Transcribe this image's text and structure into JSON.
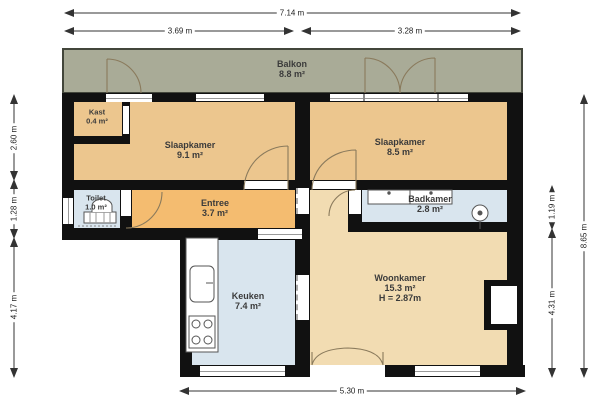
{
  "plan": {
    "rooms": {
      "balkon": {
        "name": "Balkon",
        "area": "8.8 m²"
      },
      "kast": {
        "name": "Kast",
        "area": "0.4 m²"
      },
      "slaapkamer1": {
        "name": "Slaapkamer",
        "area": "9.1 m²"
      },
      "slaapkamer2": {
        "name": "Slaapkamer",
        "area": "8.5 m²"
      },
      "toilet": {
        "name": "Toilet",
        "area": "1.0 m²"
      },
      "entree": {
        "name": "Entree",
        "area": "3.7 m²"
      },
      "badkamer": {
        "name": "Badkamer",
        "area": "2.8 m²"
      },
      "keuken": {
        "name": "Keuken",
        "area": "7.4 m²"
      },
      "woonkamer": {
        "name": "Woonkamer",
        "area": "15.3 m²",
        "ceiling_height": "H = 2.87m"
      }
    },
    "dimensions": {
      "top_total": "7.14 m",
      "top_left": "3.69 m",
      "top_right": "3.28 m",
      "left_upper": "2.60 m",
      "left_middle": "1.28 m",
      "left_lower": "4.17 m",
      "right_inner_upper": "1.19 m",
      "right_inner_lower": "4.31 m",
      "right_total": "8.65 m",
      "bottom": "5.30 m"
    },
    "colors": {
      "balcony": "#a9ab97",
      "bedroom": "#ecc68e",
      "entree": "#f4bc70",
      "living": "#f2dcb2",
      "wet_room": "#d9e5ee",
      "wall": "#111111"
    }
  }
}
